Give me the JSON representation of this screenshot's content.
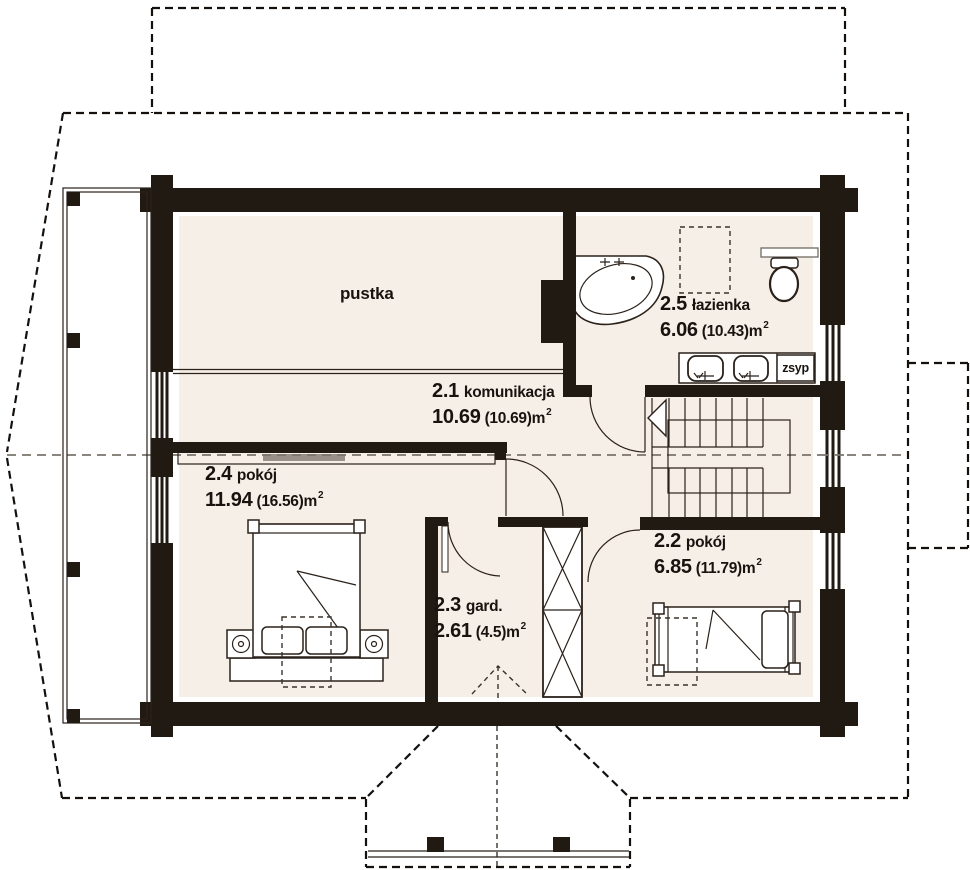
{
  "palette": {
    "wall": "#211a13",
    "floor": "#f6efe8",
    "line": "#2a211a",
    "ridge": "#7a746c"
  },
  "labels": {
    "void": "pustka",
    "chute": "zsyp"
  },
  "rooms": [
    {
      "id": "2.1",
      "name": "komunikacja",
      "area": "10.69",
      "gross": "(10.69)m",
      "sup": "2"
    },
    {
      "id": "2.2",
      "name": "pokój",
      "area": "6.85",
      "gross": "(11.79)m",
      "sup": "2"
    },
    {
      "id": "2.3",
      "name": "gard.",
      "area": "2.61",
      "gross": "(4.5)m",
      "sup": "2"
    },
    {
      "id": "2.4",
      "name": "pokój",
      "area": "11.94",
      "gross": "(16.56)m",
      "sup": "2"
    },
    {
      "id": "2.5",
      "name": "łazienka",
      "area": "6.06",
      "gross": "(10.43)m",
      "sup": "2"
    }
  ]
}
